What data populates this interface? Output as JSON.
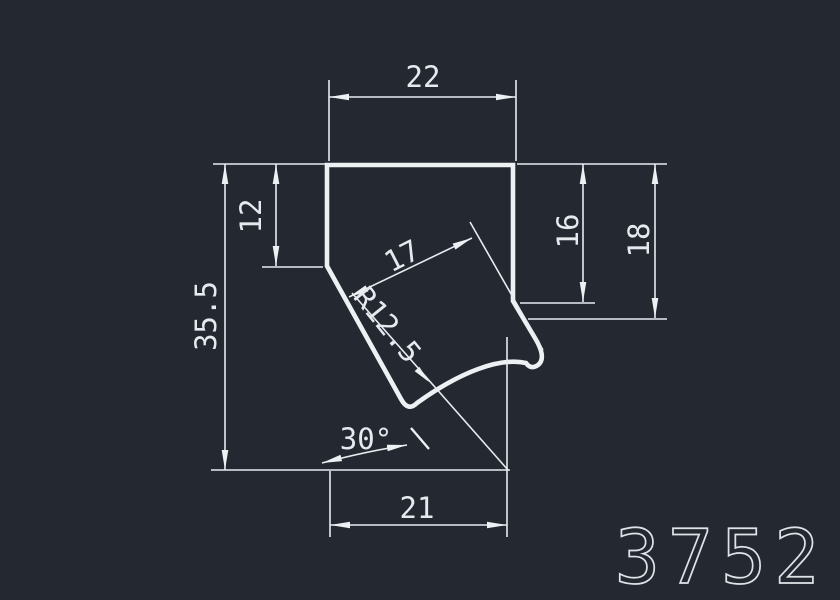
{
  "drawing": {
    "title": "profile-cross-section",
    "part_number": "3752",
    "colors": {
      "background": "#242830",
      "line": "#eef1f4",
      "text": "#e6eaee"
    },
    "dimensions": {
      "top_width": "22",
      "left_inner_height": "12",
      "overall_height": "35.5",
      "slot_width": "17",
      "radius": "R12.5",
      "right_inner_height": "16",
      "right_outer_height": "18",
      "angle": "30°",
      "bottom_width": "21"
    }
  }
}
